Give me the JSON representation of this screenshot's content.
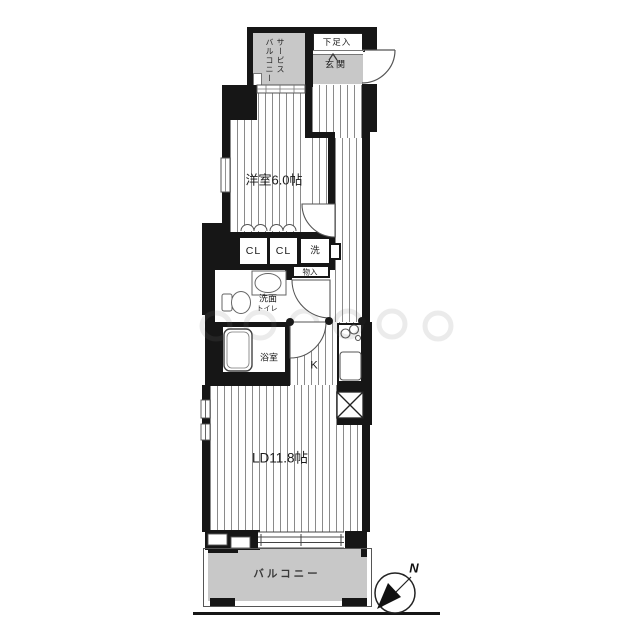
{
  "labels": {
    "service_balcony_line1": "サービス",
    "service_balcony_line2": "バルコニー",
    "shoe_storage": "下足入",
    "entrance": "玄関",
    "western_room": "洋室6.0帖",
    "closet_left": "CL",
    "closet_right": "CL",
    "washer": "洗",
    "storage": "物入",
    "washroom": "洗面",
    "toilet": "トイレ",
    "bathroom": "浴室",
    "kitchen": "K",
    "living_dining": "LD11.8帖",
    "balcony": "バルコニー",
    "compass_north": "N"
  },
  "colors": {
    "wall": "#161616",
    "area_gray": "#c8c8c8",
    "stripe_line": "#8a8a8a",
    "fixture_stroke": "#555555"
  }
}
